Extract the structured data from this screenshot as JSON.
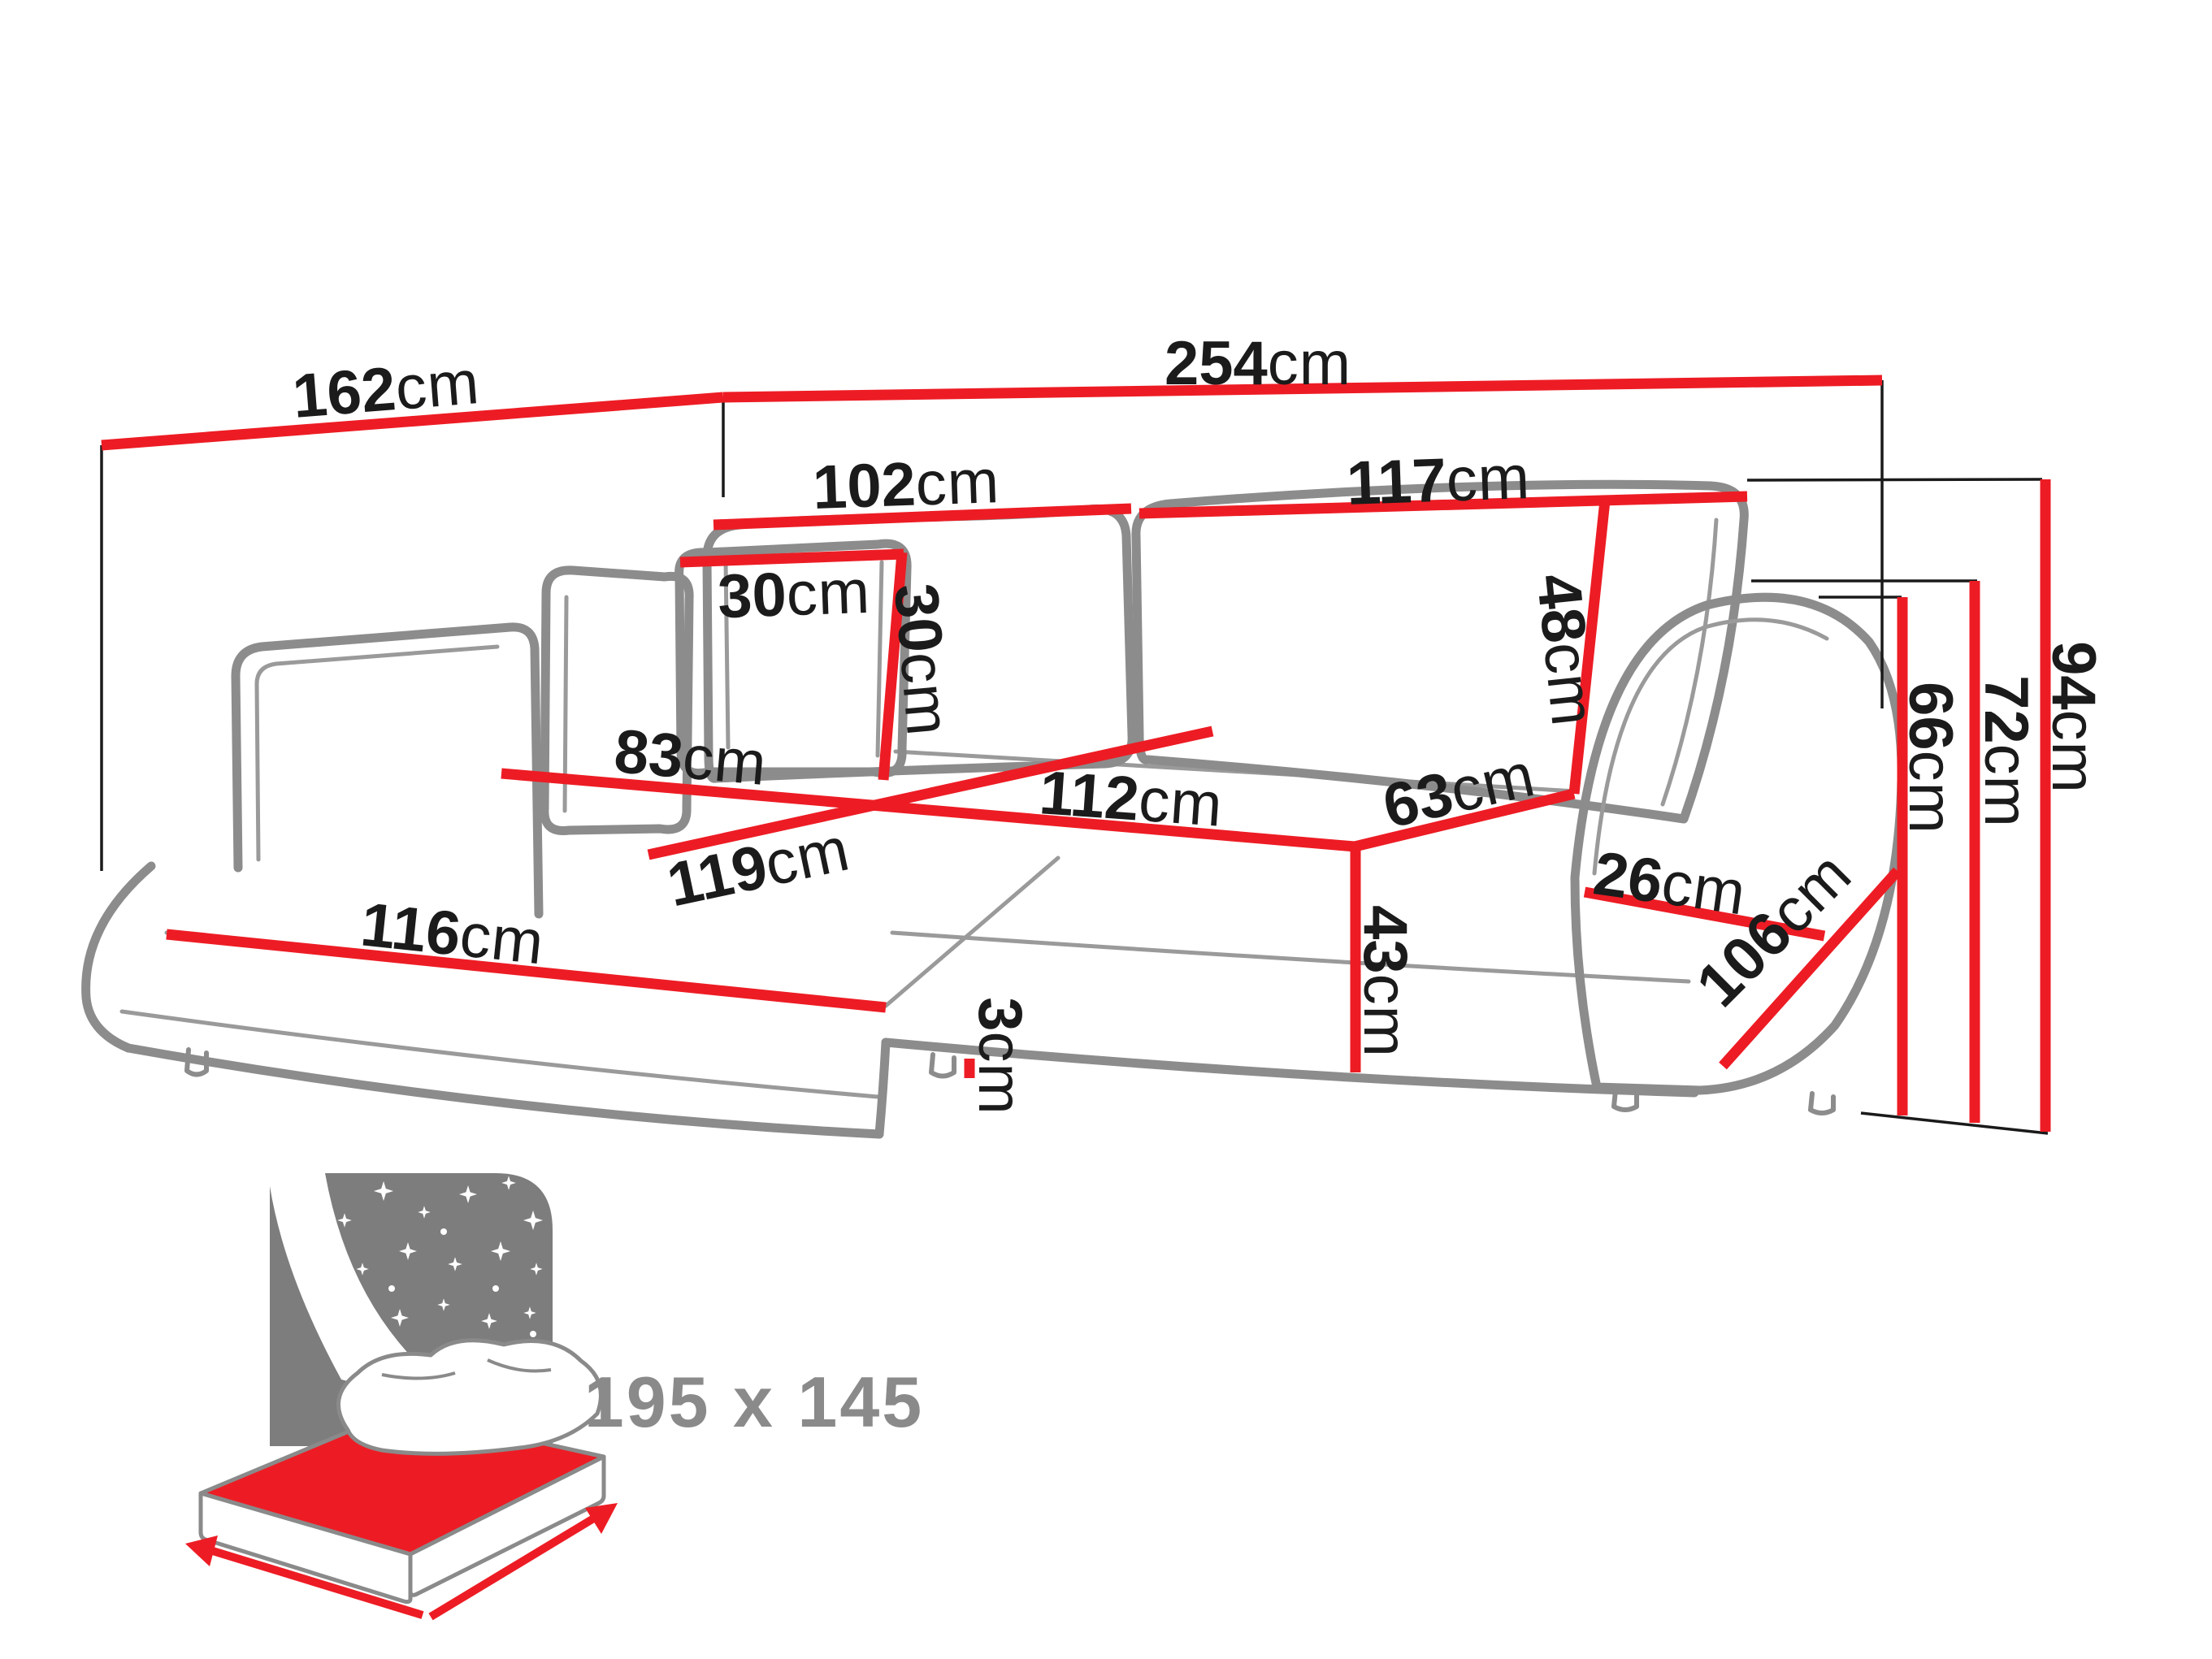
{
  "diagram": {
    "type": "corner-sofa-dimension-diagram",
    "unit": "cm",
    "dimensions": {
      "chaise_depth": {
        "value": "162",
        "unit": "cm"
      },
      "total_width": {
        "value": "254",
        "unit": "cm"
      },
      "back_cushion_left_width": {
        "value": "102",
        "unit": "cm"
      },
      "back_cushion_right_width": {
        "value": "117",
        "unit": "cm"
      },
      "pillow_width": {
        "value": "30",
        "unit": "cm"
      },
      "pillow_height": {
        "value": "30",
        "unit": "cm"
      },
      "back_cushion_height": {
        "value": "48",
        "unit": "cm"
      },
      "chaise_seat_width": {
        "value": "83",
        "unit": "cm"
      },
      "seat_front_width": {
        "value": "112",
        "unit": "cm"
      },
      "chaise_length": {
        "value": "116",
        "unit": "cm"
      },
      "chaise_front_edge": {
        "value": "119",
        "unit": "cm"
      },
      "seat_depth_right": {
        "value": "63",
        "unit": "cm"
      },
      "seat_height": {
        "value": "43",
        "unit": "cm"
      },
      "leg_height": {
        "value": "3",
        "unit": "cm"
      },
      "armrest_width": {
        "value": "26",
        "unit": "cm"
      },
      "armrest_height": {
        "value": "66",
        "unit": "cm"
      },
      "arm_back_height": {
        "value": "72",
        "unit": "cm"
      },
      "total_height": {
        "value": "94",
        "unit": "cm"
      },
      "armrest_depth_diagonal": {
        "value": "106",
        "unit": "cm"
      }
    },
    "sleeping_area": {
      "label": "195 x 145"
    },
    "colors": {
      "dimension_line": "#ed1c24",
      "sofa_outline": "#8c8c8c",
      "reference_line": "#1a1a1a",
      "label_text": "#1b1b1b",
      "bed_icon_gray": "#7d7d7d",
      "bed_size_text": "#8a8a8a"
    }
  }
}
